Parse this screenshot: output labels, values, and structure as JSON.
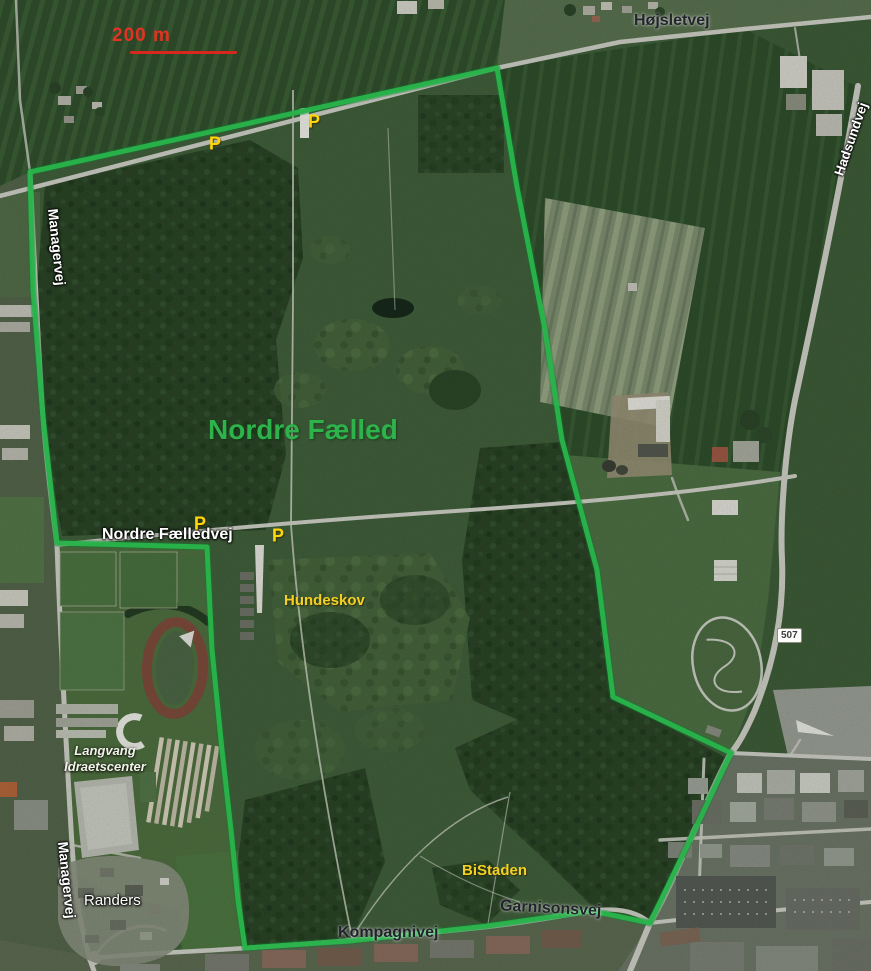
{
  "map": {
    "region_title": "Nordre Fælled",
    "scale_bar": {
      "label": "200 m",
      "color": "#e23222"
    },
    "boundary": {
      "color": "#28b44b",
      "points": "30,172 497,68 517,187 545,330 562,440 597,570 613,697 731,753 690,840 650,923 592,911 487,926 350,941 245,948 238,900 231,830 222,750 212,650 207,547 57,543 43,417 33,290"
    },
    "road_labels": {
      "hojsletvej": "Højsletvej",
      "hadsundvej": "Hadsundvej",
      "managervej_north": "Managervej",
      "managervej_south": "Managervej",
      "nordre_faelledvej": "Nordre Fælledvej",
      "garnisonsvej": "Garnisonsvej",
      "kompagnivej": "Kompagnivej"
    },
    "place_labels": {
      "nordre_faelled": "Nordre Fælled",
      "hundeskov": "Hundeskov",
      "bistaden": "BiStaden",
      "randers": "Randers",
      "langvang_line1": "Langvang",
      "langvang_line2": "Idraetscenter"
    },
    "route_badge": "507",
    "parking_label": "P",
    "colors": {
      "boundary_green": "#28b44b",
      "title_green": "#2eb24c",
      "parking_yellow": "#ffd60a",
      "poi_yellow": "#f2d124",
      "scale_red": "#e23222"
    }
  }
}
